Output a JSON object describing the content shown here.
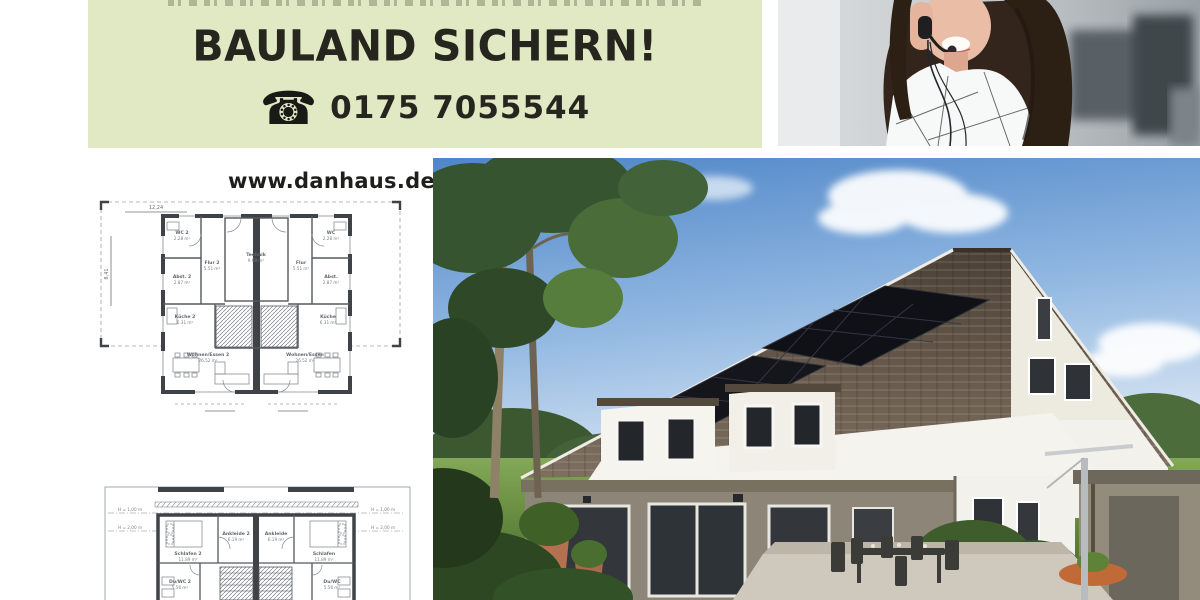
{
  "banner": {
    "headline": "BAULAND SICHERN!",
    "phone_icon_glyph": "☎",
    "phone_number": "0175 7055544",
    "bg_color": "#e0e8c4",
    "text_color": "#26261f"
  },
  "website": {
    "label": "www.danhaus.de"
  },
  "images": {
    "agent_photo": "smiling-woman-with-headset",
    "house_photo": "modern-house-with-solar-panels-and-garden"
  },
  "floorplan_ground": {
    "dim_width": "12,24",
    "dim_depth": "8,41",
    "rooms": {
      "wc2": {
        "name": "WC 2",
        "area": "2.28 m²"
      },
      "abst2": {
        "name": "Abst. 2",
        "area": "2.87 m²"
      },
      "flur2": {
        "name": "Flur 2",
        "area": "5.51 m²"
      },
      "kueche2": {
        "name": "Küche 2",
        "area": "6.31 m²"
      },
      "wohnen2": {
        "name": "Wohnen/Essen 2",
        "area": "26.52 m²"
      },
      "technik": {
        "name": "Technik",
        "area": "9.69 m²"
      },
      "wc": {
        "name": "WC",
        "area": "2.28 m²"
      },
      "abst": {
        "name": "Abst.",
        "area": "2.87 m²"
      },
      "flur": {
        "name": "Flur",
        "area": "5.51 m²"
      },
      "kueche": {
        "name": "Küche",
        "area": "6.31 m²"
      },
      "wohnen": {
        "name": "Wohnen/Essen",
        "area": "26.52 m²"
      }
    }
  },
  "floorplan_upper": {
    "height_line_1": "H = 1,00 m",
    "height_line_2": "H = 2,00 m",
    "rooms": {
      "schlafen2": {
        "name": "Schlafen 2",
        "area": "11.89 m²"
      },
      "ankleide2": {
        "name": "Ankleide 2",
        "area": "6.19 m²"
      },
      "duwc2": {
        "name": "Du/WC 2",
        "area": "5.56 m²"
      },
      "schlafen": {
        "name": "Schlafen",
        "area": "11.89 m²"
      },
      "ankleide": {
        "name": "Ankleide",
        "area": "6.19 m²"
      },
      "duwc": {
        "name": "Du/WC",
        "area": "5.56 m²"
      }
    }
  },
  "colors": {
    "banner_bg": "#e0e8c4",
    "ink": "#26261f",
    "plan_wall": "#3f4246",
    "plan_text": "#70757a",
    "sky": "#6d9bd0",
    "roof": "#5d5044",
    "lawn": "#6f9c42"
  }
}
